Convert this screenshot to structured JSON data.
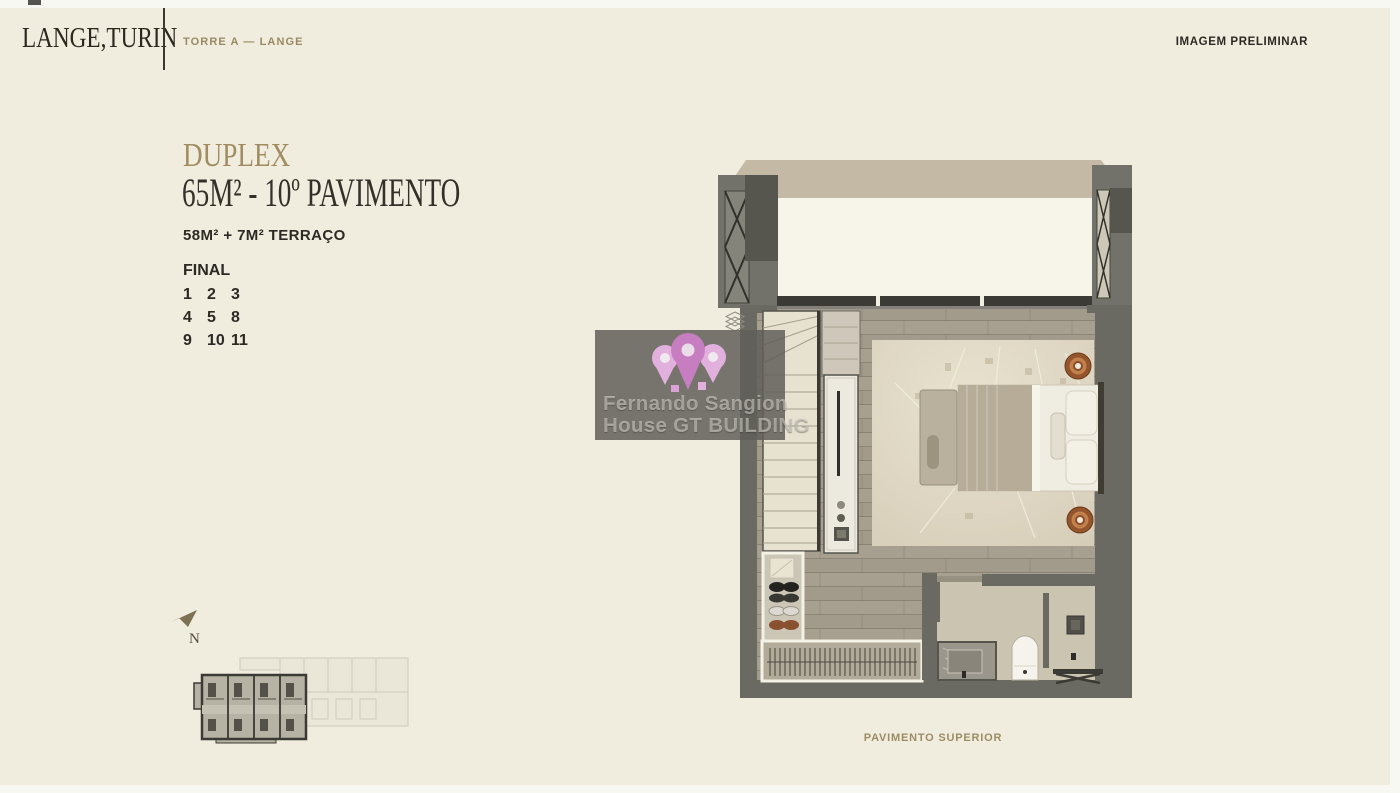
{
  "header": {
    "logo": "LANGE,TURIN",
    "tower_label": "TORRE A — LANGE",
    "disclaimer": "IMAGEM PRELIMINAR"
  },
  "unit": {
    "type_label": "DUPLEX",
    "title": "65M² - 10º PAVIMENTO",
    "area_detail": "58M² + 7M² TERRAÇO",
    "final_label": "FINAL",
    "final_numbers": [
      [
        "1",
        "2",
        "3"
      ],
      [
        "4",
        "5",
        "8"
      ],
      [
        "9",
        "10",
        "11"
      ]
    ]
  },
  "compass": {
    "label": "N"
  },
  "floor_plan": {
    "caption": "PAVIMENTO SUPERIOR"
  },
  "watermark": {
    "line1": "Fernando Sangion",
    "line2": "House GT BUILDING"
  },
  "colors": {
    "background": "#F0EDDE",
    "accent_tan": "#9D8C64",
    "text_dark": "#2B2A24",
    "wall_gray": "#6B6A62",
    "roof_beige": "#C3B9A4",
    "watermark_pink": "#CB7FC6",
    "nightstand_rust": "#94552C"
  }
}
